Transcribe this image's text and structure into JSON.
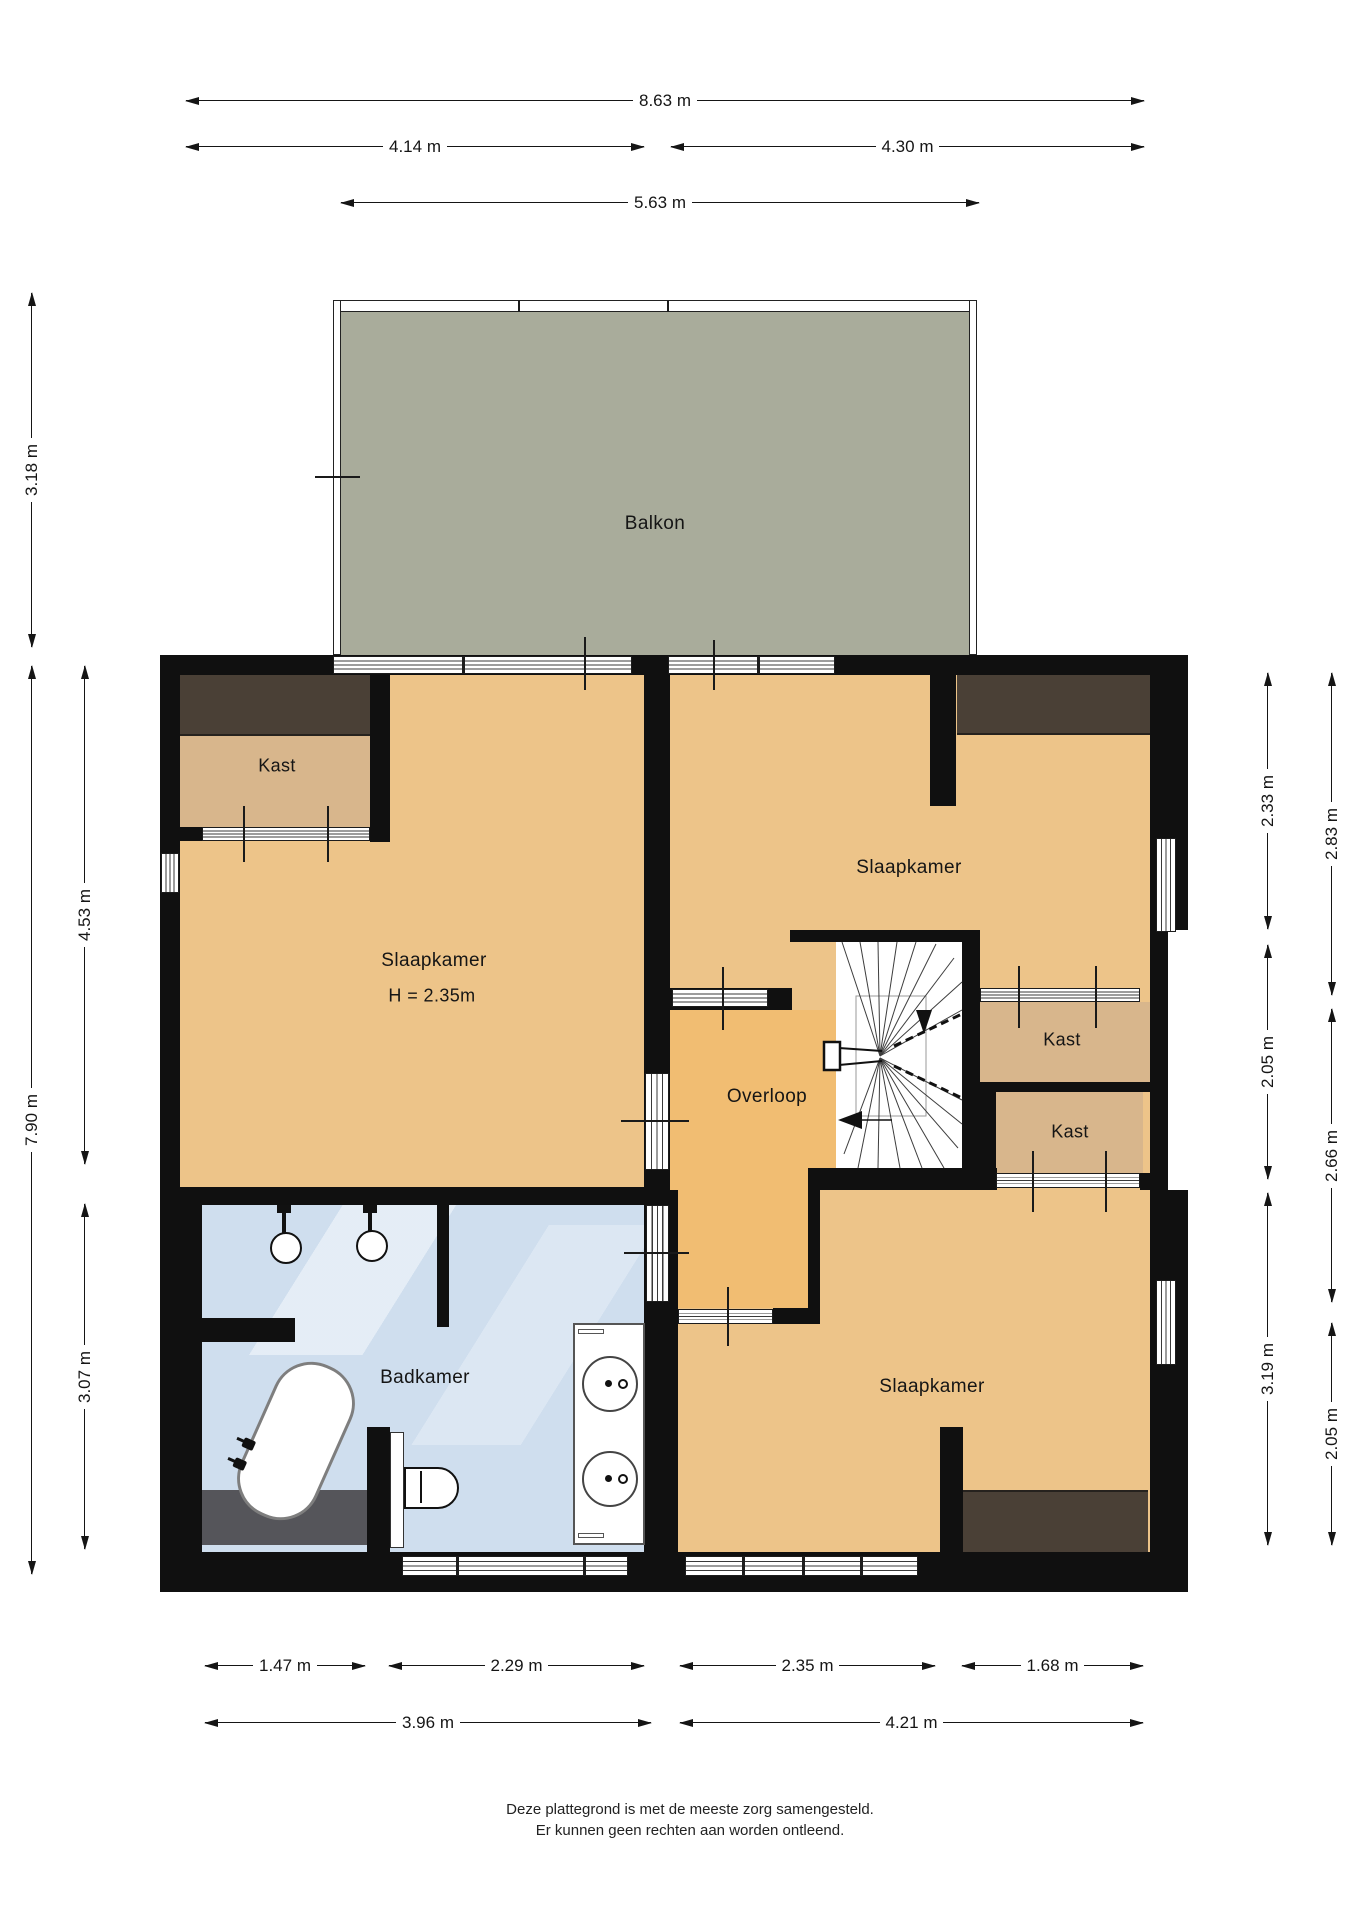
{
  "labels": {
    "balkon": "Balkon",
    "slaapkamer": "Slaapkamer",
    "height_note": "H = 2.35m",
    "overloop": "Overloop",
    "badkamer": "Badkamer",
    "kast": "Kast"
  },
  "dimensions": {
    "w_total": "8.63 m",
    "w_left": "4.14 m",
    "w_right": "4.30 m",
    "w_balcony": "5.63 m",
    "h_balcony": "3.18 m",
    "h_bedleft": "4.53 m",
    "h_total": "7.90 m",
    "h_bath": "3.07 m",
    "r_in_top": "2.33 m",
    "r_in_mid": "2.05 m",
    "r_in_bot": "3.19 m",
    "r_out_top": "2.83 m",
    "r_out_mid": "2.66 m",
    "r_out_bot": "2.05 m",
    "b_kast": "1.47 m",
    "b_bath": "2.29 m",
    "b_hall": "2.35 m",
    "b_ward": "1.68 m",
    "b_left": "3.96 m",
    "b_right": "4.21 m"
  },
  "footer": {
    "line1": "Deze plattegrond is met de meeste zorg samengesteld.",
    "line2": "Er kunnen geen rechten aan worden ontleend."
  },
  "colors": {
    "wall": "#101010",
    "bedroom_floor": "#edc489",
    "landing_floor": "#f1bd72",
    "closet_floor": "#d8b68c",
    "wardrobe": "#4a4036",
    "balcony_floor": "#a9ac9b",
    "bathroom_floor": "#cfdeee",
    "bath_dark_strip": "#55555a"
  }
}
